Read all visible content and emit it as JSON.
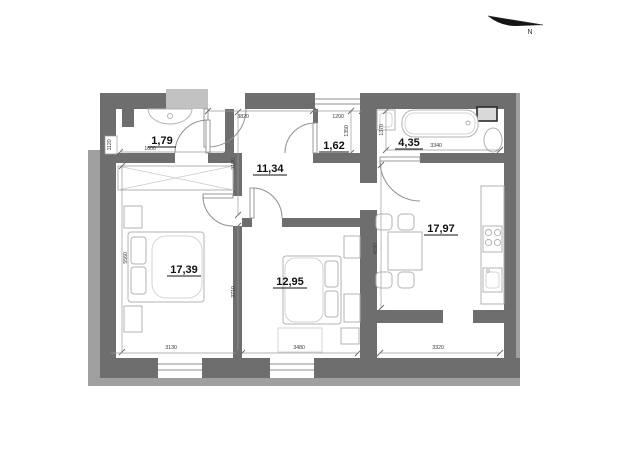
{
  "compass": {
    "label": "N"
  },
  "rooms": {
    "wc": {
      "area": "1,79"
    },
    "hallway": {
      "area": "11,34"
    },
    "closet": {
      "area": "1,62"
    },
    "bathroom": {
      "area": "4,35"
    },
    "kitchen_living": {
      "area": "17,97"
    },
    "bedroom_main": {
      "area": "17,39"
    },
    "bedroom_second": {
      "area": "12,95"
    }
  },
  "dimensions": {
    "entry_top": "3820",
    "closet_top": "1200",
    "closet_depth": "1350",
    "bathroom_depth": "1370",
    "bathroom_width": "3340",
    "hallway_depth": "3190",
    "wc_width": "1600",
    "wc_depth": "1120",
    "bedroom_main_height": "5560",
    "bedroom_second_depth": "3710",
    "kitchen_depth": "4190",
    "bedroom_main_width": "3130",
    "bedroom_second_width": "3480",
    "balcony_width": "3320"
  },
  "colors": {
    "wall": "#6e6e6e",
    "wall_light": "#9f9f9f",
    "landing": "#c2c2c2",
    "dimension_line": "#9a9a9a",
    "furniture": "#b3b3b3",
    "label": "#111111"
  }
}
